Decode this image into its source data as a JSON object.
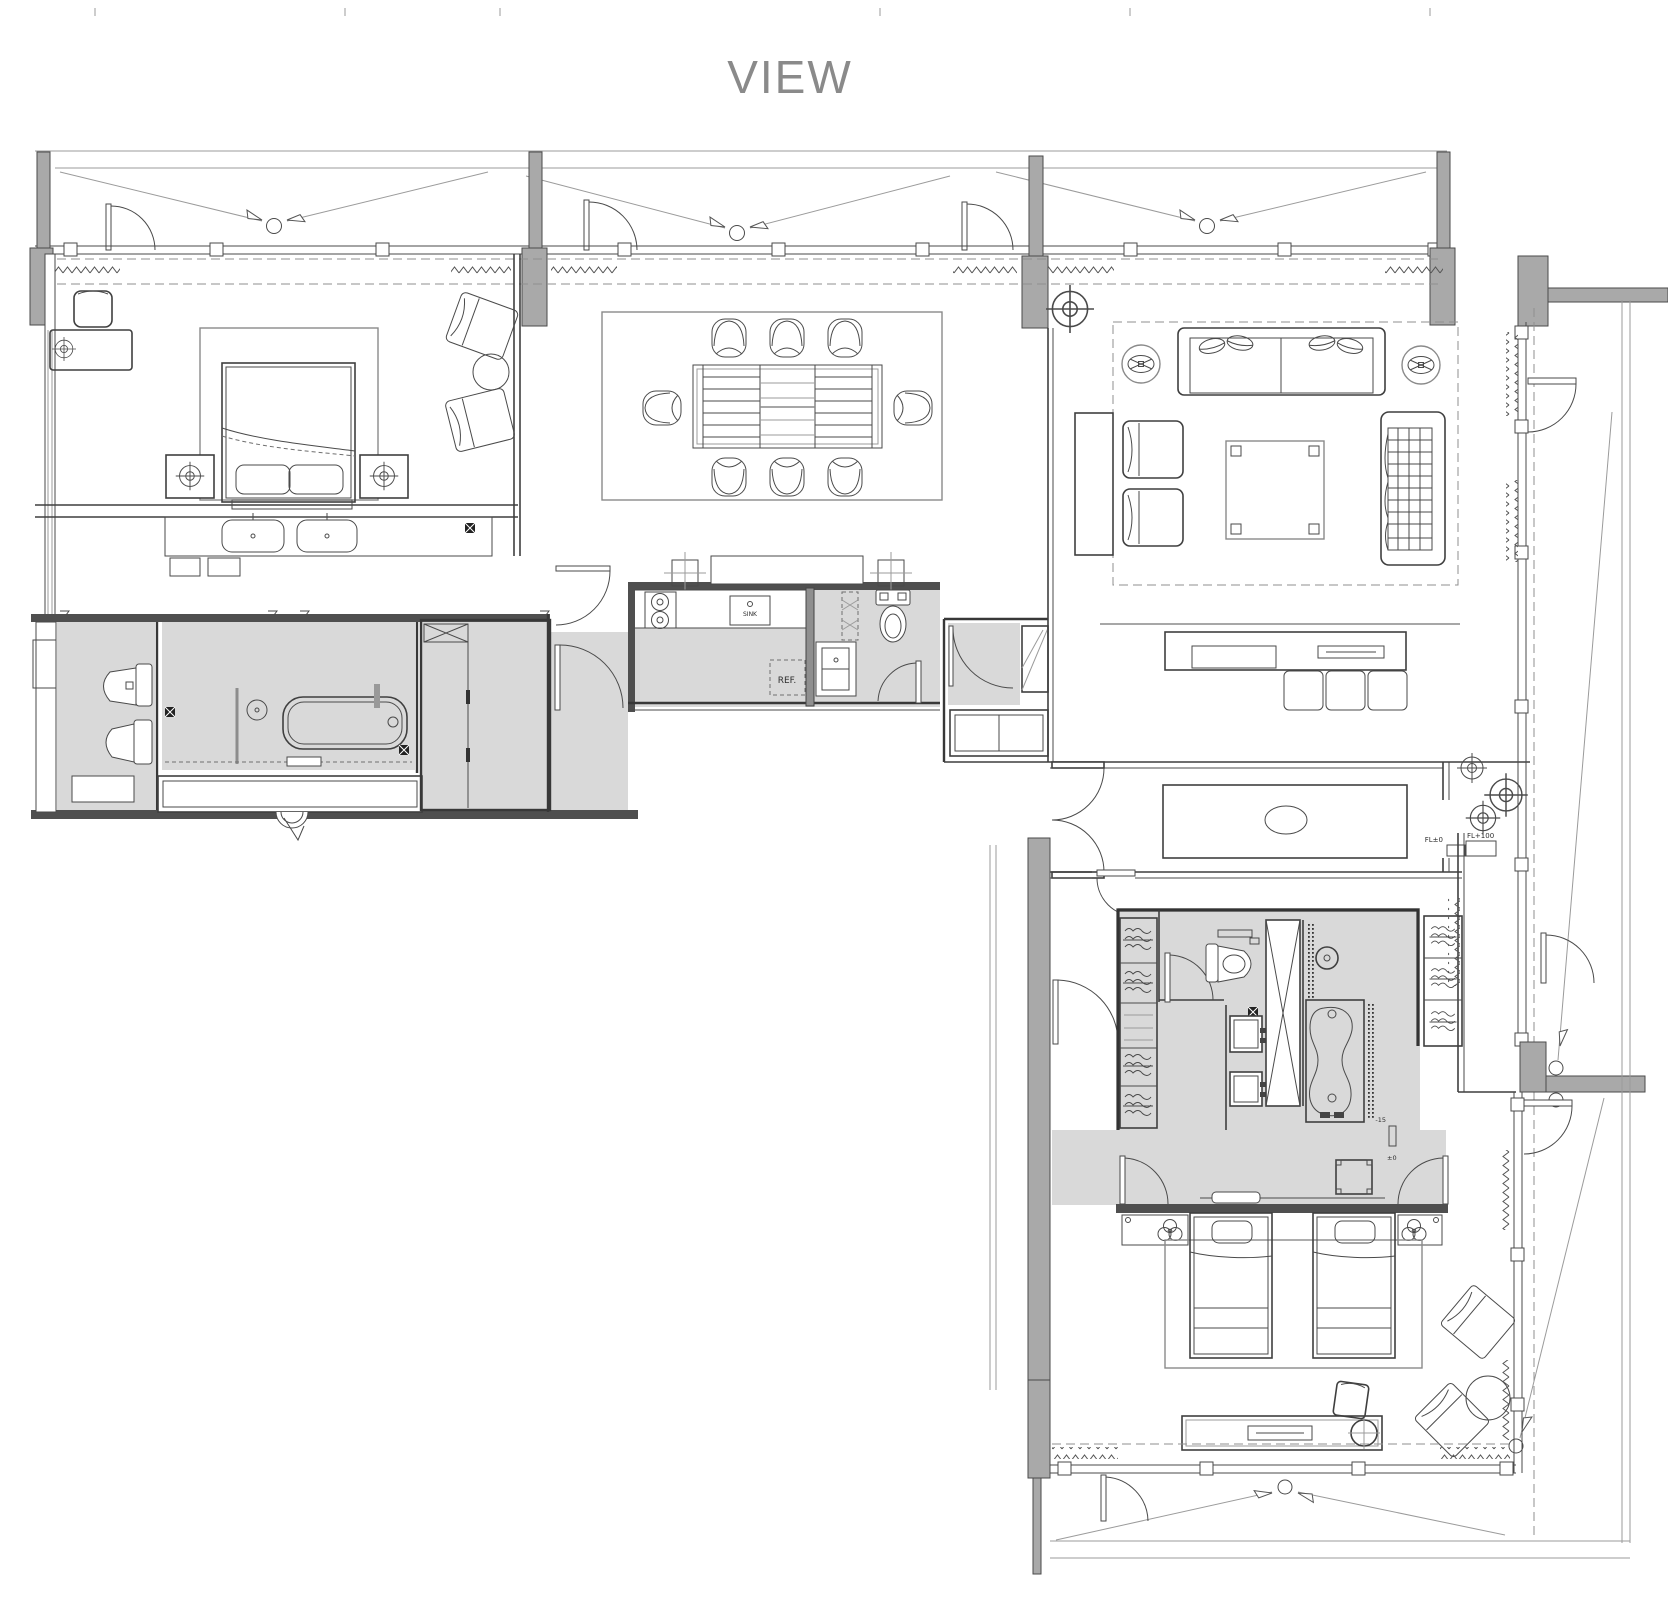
{
  "title": "VIEW",
  "labels": {
    "sink": "SINK",
    "refrigerator": "REF.",
    "floor_level_zero": "FL±0",
    "floor_level_plus_100": "FL+100",
    "level_minus_15": "-15",
    "level_plus_minus_zero": "±0"
  },
  "colors": {
    "background": "#ffffff",
    "line": "#4a4a4a",
    "light_line": "#9b9b9b",
    "wet_area_fill": "#d9d9d9",
    "column_fill": "#a9a9a9",
    "wall_fill": "#4f4f4f",
    "title_color": "#8a8a8a"
  }
}
